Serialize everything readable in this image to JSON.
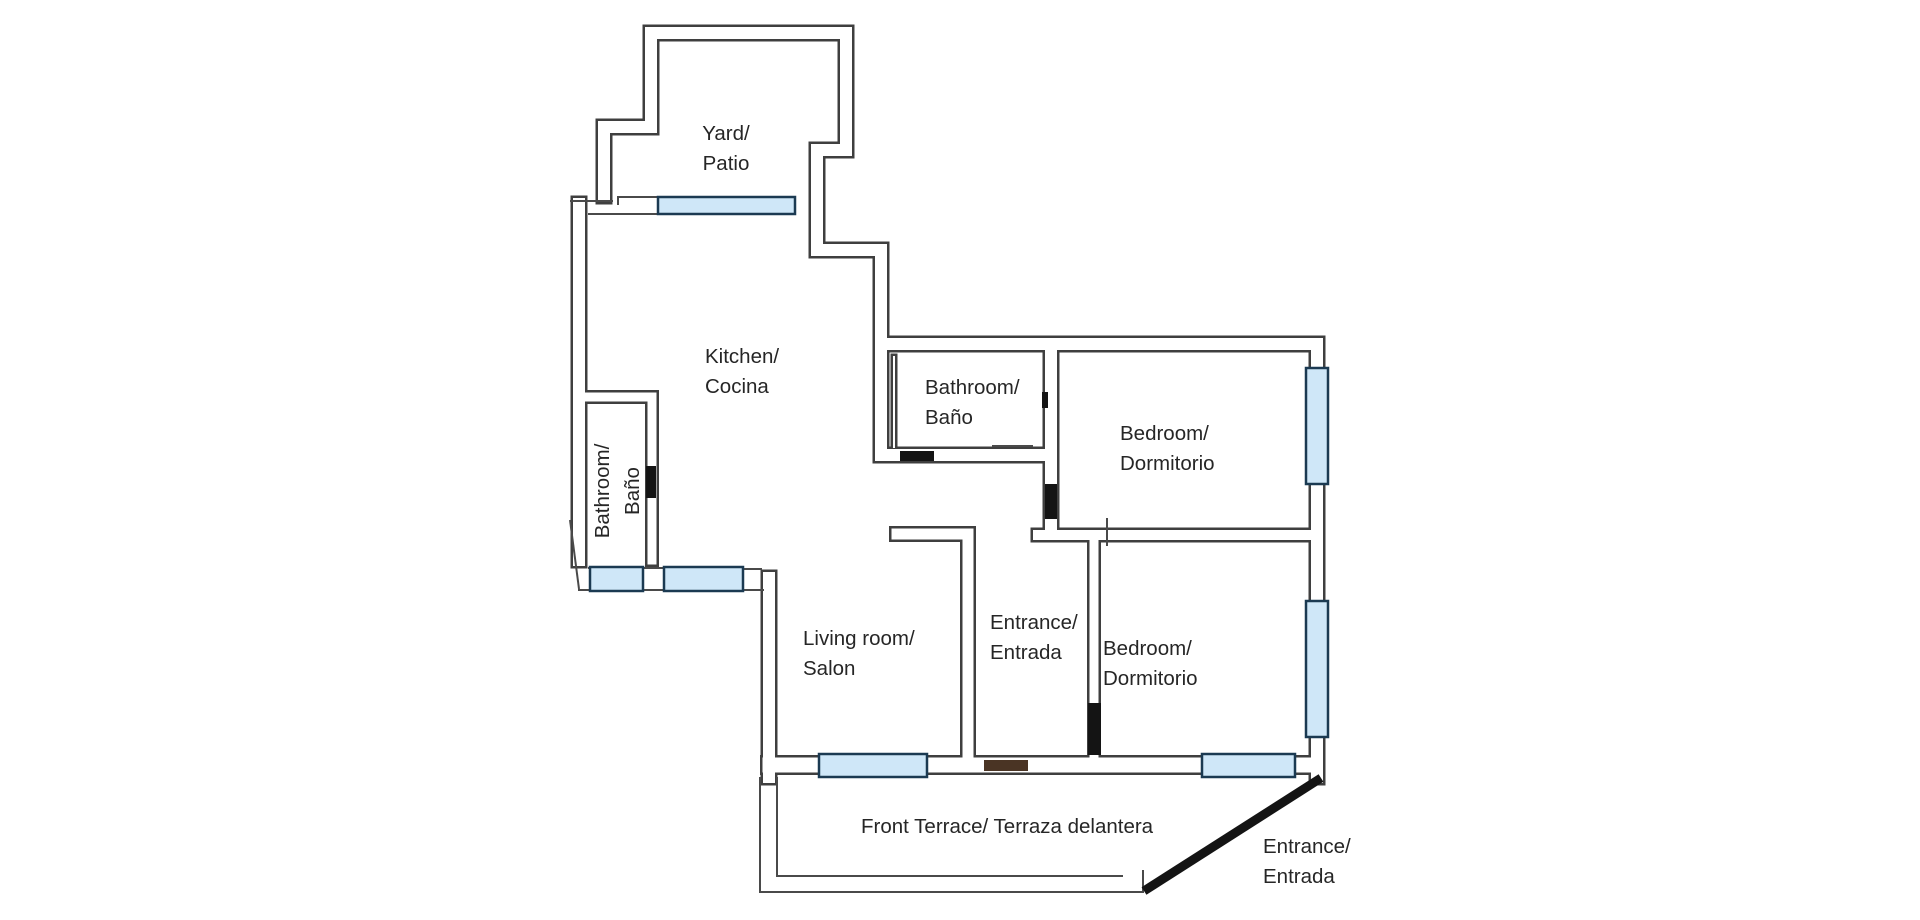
{
  "page": {
    "title": "Apartment floor plan"
  },
  "floorplan": {
    "canvas": {
      "width": 1920,
      "height": 920,
      "background": "#ffffff"
    },
    "colors": {
      "wall": "#3f3f3f",
      "thin_line": "#4a4a4a",
      "door": "#141414",
      "front_door": "#4a3424",
      "window_fill": "#cfe7f8",
      "window_border": "#1b3a52",
      "label": "#262626",
      "wall_core": "#ffffff"
    },
    "label_font": 20.5,
    "label_spacing": 30,
    "walls": [
      {
        "name": "yard-left-kitchen-outline",
        "d": "M 604 196 L 604 127 L 651 127 L 651 33 L 846 33 L 846 150 L 817 150 L 817 250 L 881 250 L 881 455 L 1051 455",
        "w": 17
      },
      {
        "name": "left-outer-wall",
        "d": "M 579 204 L 579 560",
        "w": 17
      },
      {
        "name": "living-room-left-wall",
        "d": "M 769 578 L 769 777",
        "w": 17
      },
      {
        "name": "bathroom-left-walls",
        "d": "M 588 397 L 652 397 L 652 560",
        "w": 14
      },
      {
        "name": "top-and-right-outer-wall",
        "d": "M 881 344 L 1317 344 L 1317 777",
        "w": 17
      },
      {
        "name": "bathroom-bedroom1-wall",
        "d": "M 1051 353 L 1051 528",
        "w": 17
      },
      {
        "name": "bedrooms-divider-wall",
        "d": "M 1038 535 L 1307 535",
        "w": 15
      },
      {
        "name": "living-entrance-wall",
        "d": "M 897 534 L 968 534 L 968 766",
        "w": 16
      },
      {
        "name": "entrance-bedroom2-wall",
        "d": "M 1094 542 L 1094 753",
        "w": 14
      },
      {
        "name": "bottom-facade-wall",
        "d": "M 770 765 L 1307 765",
        "w": 20
      },
      {
        "name": "bathroom-inner-left-wall",
        "d": "M 894 357 L 894 447",
        "w": 7
      }
    ],
    "thin_lines": [
      {
        "name": "yard-floor-ledge",
        "d": "M 618 205 L 618 197 L 658 197"
      },
      {
        "name": "kitchen-top-inner-line",
        "d": "M 588 214 L 658 214"
      },
      {
        "name": "left-step-line",
        "d": "M 570 201 L 613 201"
      },
      {
        "name": "window-corner-line",
        "d": "M 743 569 L 762 569"
      },
      {
        "name": "left-diagonal-wall",
        "d": "M 570 520 L 579 589"
      },
      {
        "name": "bottom-left-outer-line",
        "d": "M 578 590 L 764 590"
      },
      {
        "name": "bottom-left-inner-line",
        "d": "M 588 568 L 666 568"
      },
      {
        "name": "bathroom-fixture-line",
        "d": "M 992 446 L 1033 446"
      },
      {
        "name": "divider-tick",
        "d": "M 1107 518 L 1107 546"
      },
      {
        "name": "terrace-outer-boundary",
        "d": "M 760 777 L 760 892 L 1144 892"
      },
      {
        "name": "terrace-inner-boundary",
        "d": "M 777 777 L 777 876 L 1123 876"
      },
      {
        "name": "terrace-corner-stub",
        "d": "M 1143 870 L 1143 891"
      }
    ],
    "windows": [
      {
        "name": "yard-window",
        "x": 658,
        "y": 197,
        "w": 137,
        "h": 17
      },
      {
        "name": "bathroom-left-window",
        "x": 590,
        "y": 567,
        "w": 53,
        "h": 24
      },
      {
        "name": "kitchen-bottom-window",
        "x": 664,
        "y": 567,
        "w": 79,
        "h": 24
      },
      {
        "name": "living-room-window",
        "x": 819,
        "y": 754,
        "w": 108,
        "h": 23
      },
      {
        "name": "bedroom-2-bottom-window",
        "x": 1202,
        "y": 754,
        "w": 93,
        "h": 23
      },
      {
        "name": "bedroom-1-right-window",
        "x": 1306,
        "y": 368,
        "w": 22,
        "h": 116
      },
      {
        "name": "bedroom-2-right-window",
        "x": 1306,
        "y": 601,
        "w": 22,
        "h": 136
      }
    ],
    "doors": [
      {
        "name": "bathroom-left-door",
        "x": 646,
        "y": 466,
        "w": 10,
        "h": 32
      },
      {
        "name": "bathroom-door",
        "x": 900,
        "y": 451,
        "w": 34,
        "h": 10
      },
      {
        "name": "bathroom-wall-tick",
        "x": 1042,
        "y": 392,
        "w": 6,
        "h": 16
      },
      {
        "name": "bedroom-1-door",
        "x": 1045,
        "y": 484,
        "w": 12,
        "h": 35
      },
      {
        "name": "bedroom-2-door",
        "x": 1088,
        "y": 703,
        "w": 13,
        "h": 52
      },
      {
        "name": "front-door",
        "x": 984,
        "y": 760,
        "w": 44,
        "h": 11,
        "fill": "front_door"
      }
    ],
    "diagonal_entrance_line": {
      "x1": 1144,
      "y1": 891,
      "x2": 1321,
      "y2": 778,
      "w": 9
    },
    "labels": [
      {
        "name": "yard",
        "lines": [
          "Yard/",
          "Patio"
        ],
        "x": 726,
        "y": 140,
        "anchor": "middle"
      },
      {
        "name": "kitchen",
        "lines": [
          "Kitchen/",
          "Cocina"
        ],
        "x": 705,
        "y": 363,
        "anchor": "start"
      },
      {
        "name": "bathroom-left",
        "lines": [
          "Bathroom/",
          "Baño"
        ],
        "x": 617,
        "y": 491,
        "anchor": "middle",
        "rotate": -90,
        "dy0": -8
      },
      {
        "name": "bathroom",
        "lines": [
          "Bathroom/",
          "Baño"
        ],
        "x": 925,
        "y": 394,
        "anchor": "start"
      },
      {
        "name": "bedroom-1",
        "lines": [
          "Bedroom/",
          "Dormitorio"
        ],
        "x": 1120,
        "y": 440,
        "anchor": "start"
      },
      {
        "name": "living-room",
        "lines": [
          "Living room/",
          "Salon"
        ],
        "x": 803,
        "y": 645,
        "anchor": "start"
      },
      {
        "name": "entrance-hall",
        "lines": [
          "Entrance/",
          "Entrada"
        ],
        "x": 990,
        "y": 629,
        "anchor": "start"
      },
      {
        "name": "bedroom-2",
        "lines": [
          "Bedroom/",
          "Dormitorio"
        ],
        "x": 1103,
        "y": 655,
        "anchor": "start"
      },
      {
        "name": "front-terrace",
        "lines": [
          "Front Terrace/ Terraza delantera"
        ],
        "x": 861,
        "y": 833,
        "anchor": "start"
      },
      {
        "name": "entrance-outdoor",
        "lines": [
          "Entrance/",
          "Entrada"
        ],
        "x": 1263,
        "y": 853,
        "anchor": "start"
      }
    ]
  }
}
